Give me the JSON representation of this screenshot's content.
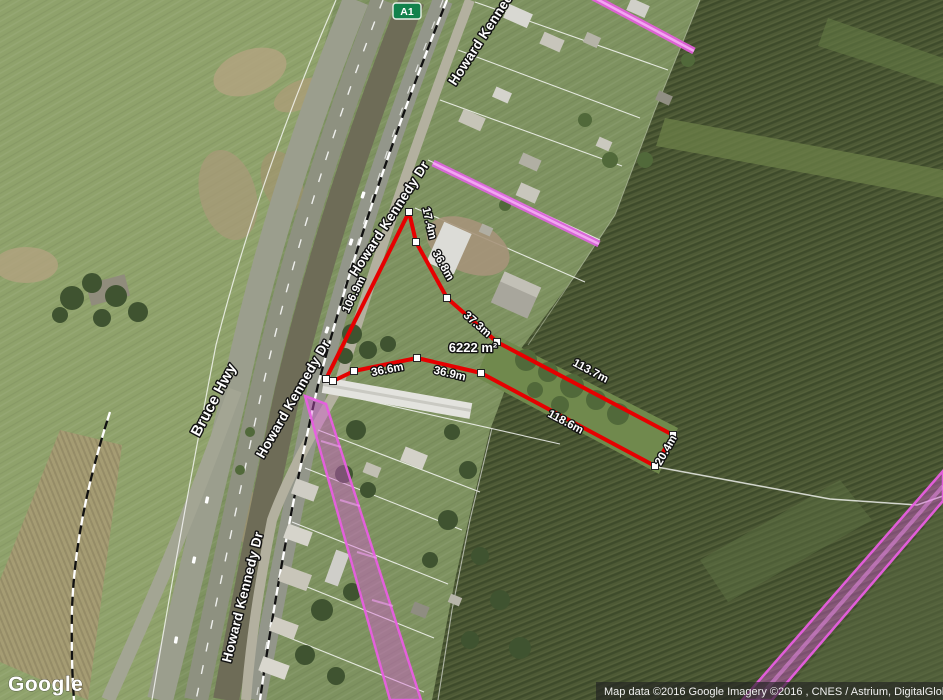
{
  "roads": {
    "shield": "A1",
    "labels": [
      {
        "name": "bruce-hwy",
        "text": "Bruce Hwy"
      },
      {
        "name": "howard-kennedy-top",
        "text": "Howard Kennedy Dr"
      },
      {
        "name": "howard-kennedy-upper",
        "text": "Howard Kennedy Dr"
      },
      {
        "name": "howard-kennedy-left",
        "text": "Howard Kennedy Dr"
      },
      {
        "name": "howard-kennedy-bottom",
        "text": "Howard Kennedy Dr"
      }
    ]
  },
  "measurement": {
    "outline_color": "#e60000",
    "segments": [
      {
        "label": "17.4m"
      },
      {
        "label": "36.8m"
      },
      {
        "label": "37.3m"
      },
      {
        "label": "106.9m"
      },
      {
        "label": "36.6m"
      },
      {
        "label": "36.9m"
      },
      {
        "label": "113.7m"
      },
      {
        "label": "118.6m"
      },
      {
        "label": "20.4m"
      }
    ],
    "area": "6222 m²"
  },
  "overlay": {
    "highlight_color": "#e85ee0"
  },
  "branding": {
    "logo": "Google"
  },
  "attribution": {
    "text": "Map data ©2016 Google  Imagery ©2016 , CNES / Astrium, DigitalGlobe"
  }
}
